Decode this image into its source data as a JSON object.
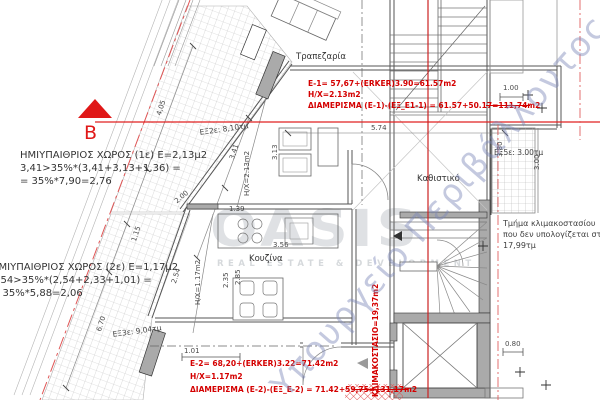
{
  "watermarks": {
    "logo": "OASIS",
    "logo_subtitle": "REAL ESTATE & DEVELOPMENT",
    "ministry": "Υπουργείο Περιβάλλοντος & Ενέργειας"
  },
  "section_marker": {
    "label": "B"
  },
  "annotations": {
    "semi_open_1": {
      "line1": "ΗΜΙΥΠΑΙΘΡΙΟΣ ΧΩΡΟΣ (1ε)  Ε=2,13μ2",
      "line2": "3,41>35%*(3,41+3,13+1,36) =",
      "line3": "= 35%*7,90=2,76"
    },
    "semi_open_2": {
      "line1": "ΗΜΙΥΠΑΙΘΡΙΟΣ ΧΩΡΟΣ (2ε)  Ε=1,17μ2",
      "line2": "2,54>35%*(2,54+2,33+1,01) =",
      "line3": "= 35%*5,88=2,06"
    },
    "apartment_1": {
      "line1": "E-1= 57,67+(ERKER)3.90=61.57m2",
      "line2": "H/X=2.13m2",
      "line3": "ΔΙΑΜΕΡΙΣΜΑ (E-1)-(ΕΞ_Ε1-1) = 61.57+50.17=111,74m2"
    },
    "apartment_2": {
      "line1": "E-2= 68,20+(ERKER)3.22=71.42m2",
      "line2": "H/X=1.17m2",
      "line3": "ΔΙΑΜΕΡΙΣΜΑ (Ε-2)-(ΕΞ_Ε-2) = 71.42+59,75=131,17m2"
    },
    "stair_note": {
      "line1": "Τμήμα κλιμακοστασίου",
      "line2": "που δεν υπολογίζεται στον συ",
      "line3": "17,99τμ"
    },
    "stairwell": "ΚΛΙΜΑΚΟΣΤΑΣΙΟ=19,37m2",
    "hx_1": "Η/Χ=2.13m2",
    "hx_2": "Η/Χ=1.17m2"
  },
  "rooms": {
    "dining": "Τραπεζαρία",
    "living": "Καθιστικό",
    "kitchen": "Κουζίνα"
  },
  "balconies": {
    "ex2": "ΕΞ2ε: 8,10τμ",
    "ex3": "ΕΞ3ε: 9,04τμ",
    "ex5": "ΕΞ5ε: 3.00τμ"
  },
  "dimensions": {
    "d405": "4,05",
    "d341": "3,41",
    "d200": "2.00",
    "d115": "1.15",
    "d254": "2.54",
    "d670": "6.70",
    "d313": "3.13",
    "d574": "5.74",
    "d380": "3.80",
    "d100": "1.00",
    "d101": "1.01",
    "d139": "1.39",
    "d356": "3.56",
    "d285": "2.85",
    "d235": "2.35",
    "d080": "0.80",
    "d300": "3.00"
  },
  "colors": {
    "annotation_red": "#d40000",
    "section_red": "#e03030",
    "wall_grey": "#aaaaaa",
    "watermark_blue": "#8a94c8"
  }
}
